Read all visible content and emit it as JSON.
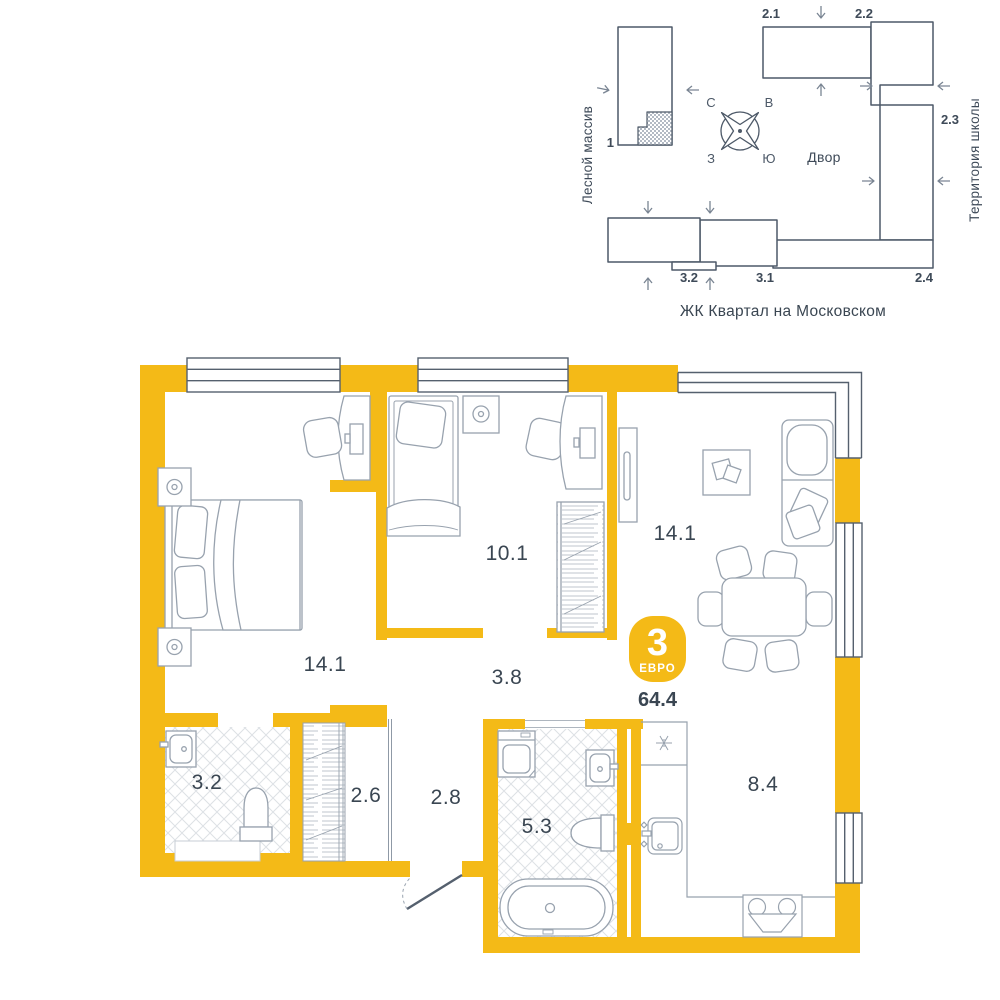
{
  "site_plan": {
    "left_area_label": "Лесной массив",
    "right_area_label": "Территория школы",
    "courtyard_label": "Двор",
    "complex_title": "ЖК Квартал на Московском",
    "compass": {
      "north": "С",
      "east": "В",
      "west": "З",
      "south": "Ю"
    },
    "buildings": [
      {
        "label": "1"
      },
      {
        "label": "2.1"
      },
      {
        "label": "2.2"
      },
      {
        "label": "2.3"
      },
      {
        "label": "2.4"
      },
      {
        "label": "3.1"
      },
      {
        "label": "3.2"
      }
    ]
  },
  "apartment": {
    "badge": {
      "rooms": "3",
      "type_label": "ЕВРО",
      "total_area": "64.4"
    },
    "rooms": [
      {
        "id": "bedroom-1",
        "area": "14.1"
      },
      {
        "id": "bedroom-2",
        "area": "10.1"
      },
      {
        "id": "living-room",
        "area": "14.1"
      },
      {
        "id": "hallway",
        "area": "3.8"
      },
      {
        "id": "wc",
        "area": "3.2"
      },
      {
        "id": "wardrobe",
        "area": "2.6"
      },
      {
        "id": "entry-hall",
        "area": "2.8"
      },
      {
        "id": "bathroom",
        "area": "5.3"
      },
      {
        "id": "kitchen",
        "area": "8.4"
      }
    ],
    "colors": {
      "wall": "#F4BA17",
      "outline": "#55606E",
      "site_outline": "#4D5968",
      "text": "#3A4652",
      "furniture": "#98A2AE"
    }
  }
}
